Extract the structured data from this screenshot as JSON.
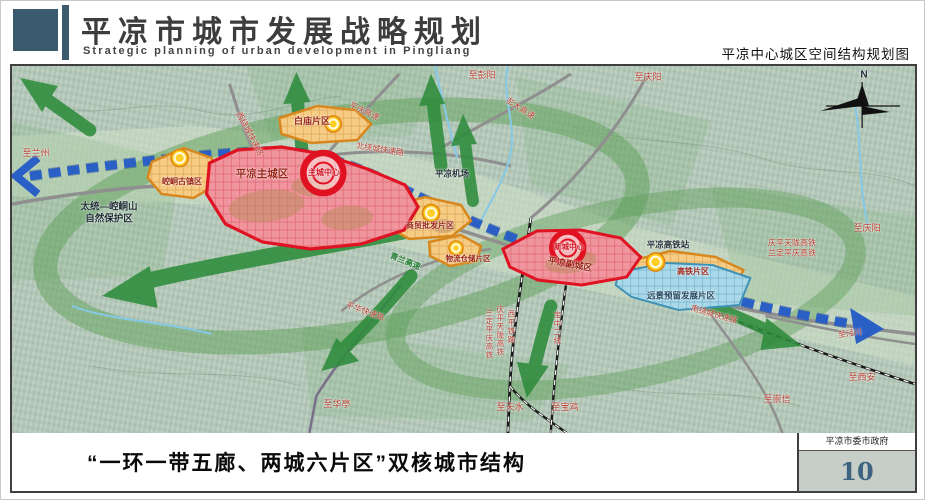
{
  "header": {
    "title": "平凉市城市发展战略规划",
    "subtitle": "Strategic planning of urban development in Pingliang",
    "map_caption": "平凉中心城区空间结构规划图"
  },
  "footer": {
    "caption": "“一环一带五廊、两城六片区”双核城市结构",
    "agency": "平凉市委市政府",
    "page_number": "10"
  },
  "colors": {
    "header_accent": "#3c5a6e",
    "core_ring_red": "#e01222",
    "main_city_fill": "#f0949e",
    "district_orange": "#f6cc85",
    "reserve_blue": "#a9d9e9",
    "belt_blue": "#2a5fc6",
    "corridor_green": "#2e8c3c",
    "page_number_blue": "#3c637f"
  },
  "map": {
    "zones": [
      {
        "name": "平凉主城区",
        "type": "city"
      },
      {
        "name": "平凉副城区",
        "type": "city"
      },
      {
        "name": "崆峒古镇区",
        "type": "district"
      },
      {
        "name": "白庙片区",
        "type": "district"
      },
      {
        "name": "商贸批发片区",
        "type": "district"
      },
      {
        "name": "物流仓储片区",
        "type": "district"
      },
      {
        "name": "高铁片区",
        "type": "district"
      },
      {
        "name": "远景预留发展片区",
        "type": "reserve"
      }
    ],
    "centers": [
      "主城中心",
      "新城中心"
    ],
    "labels": [
      {
        "t": "N",
        "x": 852,
        "y": 9,
        "c": "dark",
        "s": 10
      },
      {
        "t": "至兰州",
        "x": 24,
        "y": 88,
        "c": "red",
        "s": 9
      },
      {
        "t": "太统—崆峒山\n自然保护区",
        "x": 97,
        "y": 148,
        "c": "dark",
        "s": 9.5
      },
      {
        "t": "崆峒古镇区",
        "x": 170,
        "y": 116,
        "c": "zone",
        "s": 8
      },
      {
        "t": "平凉主城区",
        "x": 250,
        "y": 109,
        "c": "zone",
        "s": 10.5,
        "b": 1
      },
      {
        "t": "主城中心",
        "x": 312,
        "y": 107,
        "c": "center",
        "s": 8
      },
      {
        "t": "白庙片区",
        "x": 300,
        "y": 56,
        "c": "zone",
        "s": 9
      },
      {
        "t": "西绕城快速路",
        "x": 237,
        "y": 68,
        "c": "red",
        "s": 8,
        "r": 62
      },
      {
        "t": "北绕城快速路",
        "x": 368,
        "y": 84,
        "c": "red",
        "s": 8,
        "r": 9
      },
      {
        "t": "平庆高速",
        "x": 352,
        "y": 46,
        "c": "red",
        "s": 8,
        "r": 25
      },
      {
        "t": "至彭阳",
        "x": 470,
        "y": 10,
        "c": "red",
        "s": 9
      },
      {
        "t": "彭大高速",
        "x": 508,
        "y": 43,
        "c": "red",
        "s": 8,
        "r": 32
      },
      {
        "t": "至庆阳",
        "x": 636,
        "y": 12,
        "c": "red",
        "s": 9
      },
      {
        "t": "平凉机场",
        "x": 440,
        "y": 108,
        "c": "dark",
        "s": 8.5
      },
      {
        "t": "商贸批发片区",
        "x": 418,
        "y": 160,
        "c": "zone",
        "s": 8
      },
      {
        "t": "青兰高速",
        "x": 393,
        "y": 196,
        "c": "green",
        "s": 8,
        "r": 22
      },
      {
        "t": "物流仓储片区",
        "x": 456,
        "y": 193,
        "c": "zone",
        "s": 7.5
      },
      {
        "t": "新城中心",
        "x": 557,
        "y": 181,
        "c": "center",
        "s": 7.5
      },
      {
        "t": "平凉副城区",
        "x": 558,
        "y": 199,
        "c": "zone",
        "s": 9,
        "r": 10
      },
      {
        "t": "平凉高铁站",
        "x": 656,
        "y": 179,
        "c": "dark",
        "s": 8.5
      },
      {
        "t": "庆平天陇高铁\n兰定平庆高铁",
        "x": 780,
        "y": 183,
        "c": "red",
        "s": 8
      },
      {
        "t": "至庆阳",
        "x": 855,
        "y": 163,
        "c": "red",
        "s": 9
      },
      {
        "t": "高铁片区",
        "x": 681,
        "y": 206,
        "c": "zone",
        "s": 8
      },
      {
        "t": "远景预留发展片区",
        "x": 669,
        "y": 230,
        "c": "navy",
        "s": 8.5
      },
      {
        "t": "南绕城快速路",
        "x": 702,
        "y": 249,
        "c": "red",
        "s": 8,
        "r": 16
      },
      {
        "t": "至泾川",
        "x": 838,
        "y": 268,
        "c": "red",
        "s": 8,
        "r": -8
      },
      {
        "t": "至西安",
        "x": 850,
        "y": 312,
        "c": "red",
        "s": 9
      },
      {
        "t": "至崇信",
        "x": 765,
        "y": 334,
        "c": "red",
        "s": 9
      },
      {
        "t": "至华亭",
        "x": 325,
        "y": 339,
        "c": "red",
        "s": 9
      },
      {
        "t": "至天水",
        "x": 498,
        "y": 342,
        "c": "red",
        "s": 9
      },
      {
        "t": "至宝鸡",
        "x": 553,
        "y": 342,
        "c": "red",
        "s": 9
      },
      {
        "t": "平华快速路",
        "x": 353,
        "y": 246,
        "c": "red",
        "s": 8,
        "r": 20
      },
      {
        "t": "兰定平庆高铁",
        "x": 477,
        "y": 268,
        "c": "red",
        "s": 7.5,
        "v": 1
      },
      {
        "t": "庆平天陇高铁",
        "x": 488,
        "y": 265,
        "c": "red",
        "s": 7.5,
        "v": 1
      },
      {
        "t": "西平铁路",
        "x": 499,
        "y": 261,
        "c": "red",
        "s": 7.5,
        "v": 1
      },
      {
        "t": "宝中二线",
        "x": 545,
        "y": 262,
        "c": "red",
        "s": 7.5,
        "v": 1
      }
    ]
  }
}
